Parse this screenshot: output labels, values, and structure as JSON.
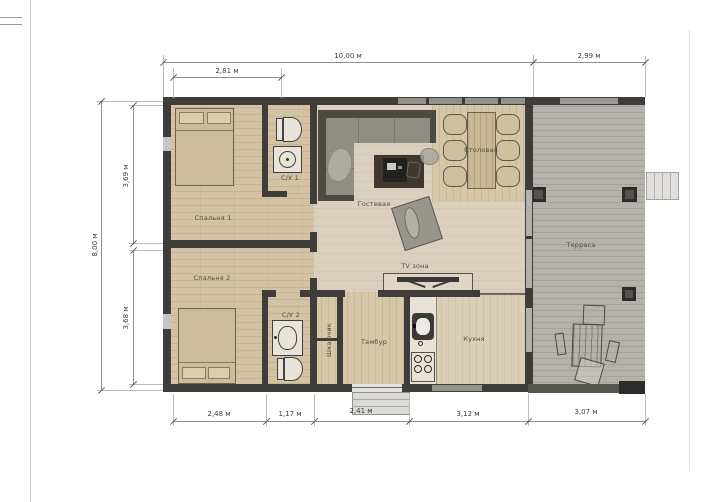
{
  "drawing_type": "floor-plan",
  "rooms": {
    "bedroom1": "Спальня 1",
    "bedroom2": "Спальня 2",
    "bath1": "С/У 1",
    "bath2": "С/У 2",
    "living": "Гостевая",
    "dining": "Столовая",
    "tv_zone": "TV зона",
    "closet": "Шкафчик",
    "vestibule": "Тамбур",
    "kitchen": "Кухня",
    "terrace": "Терраса"
  },
  "dims": {
    "top_total": "10,00 м",
    "top_left": "2,81 м",
    "top_terrace": "2,99 м",
    "left_total": "8,00 м",
    "left_top": "3,69 м",
    "left_bottom": "3,68 м",
    "bottom_1": "2,48 м",
    "bottom_2": "1,17 м",
    "bottom_3": "2,41 м",
    "bottom_4": "3,12 м",
    "bottom_5": "3,07 м"
  },
  "colors": {
    "wall": "#3e3d3a",
    "wood_floor": "#d3c3a4",
    "living_floor": "#dad0bd",
    "terrace_floor": "#b5b2ab",
    "dim_text": "#3c3c3c"
  }
}
